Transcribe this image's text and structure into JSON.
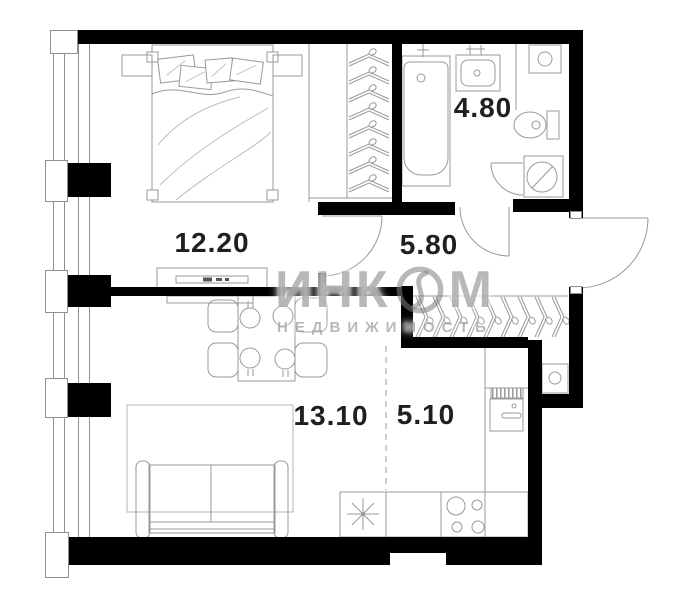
{
  "plan": {
    "title": "apartment-floor-plan",
    "rooms": [
      {
        "name": "bedroom",
        "area": "12.20"
      },
      {
        "name": "bathroom",
        "area": "4.80"
      },
      {
        "name": "hallway",
        "area": "5.80"
      },
      {
        "name": "living-room",
        "area": "13.10"
      },
      {
        "name": "kitchen",
        "area": "5.10"
      }
    ],
    "watermark": {
      "brand": "ИНКОМ",
      "brand_left": "ИНК",
      "brand_right": "М",
      "line2": "НЕДВИЖИМОСТЬ"
    },
    "colors": {
      "wall": "#000000",
      "furniture_line": "#999999",
      "label_text": "#1f1f1f",
      "watermark": "#7d7d7d"
    }
  }
}
